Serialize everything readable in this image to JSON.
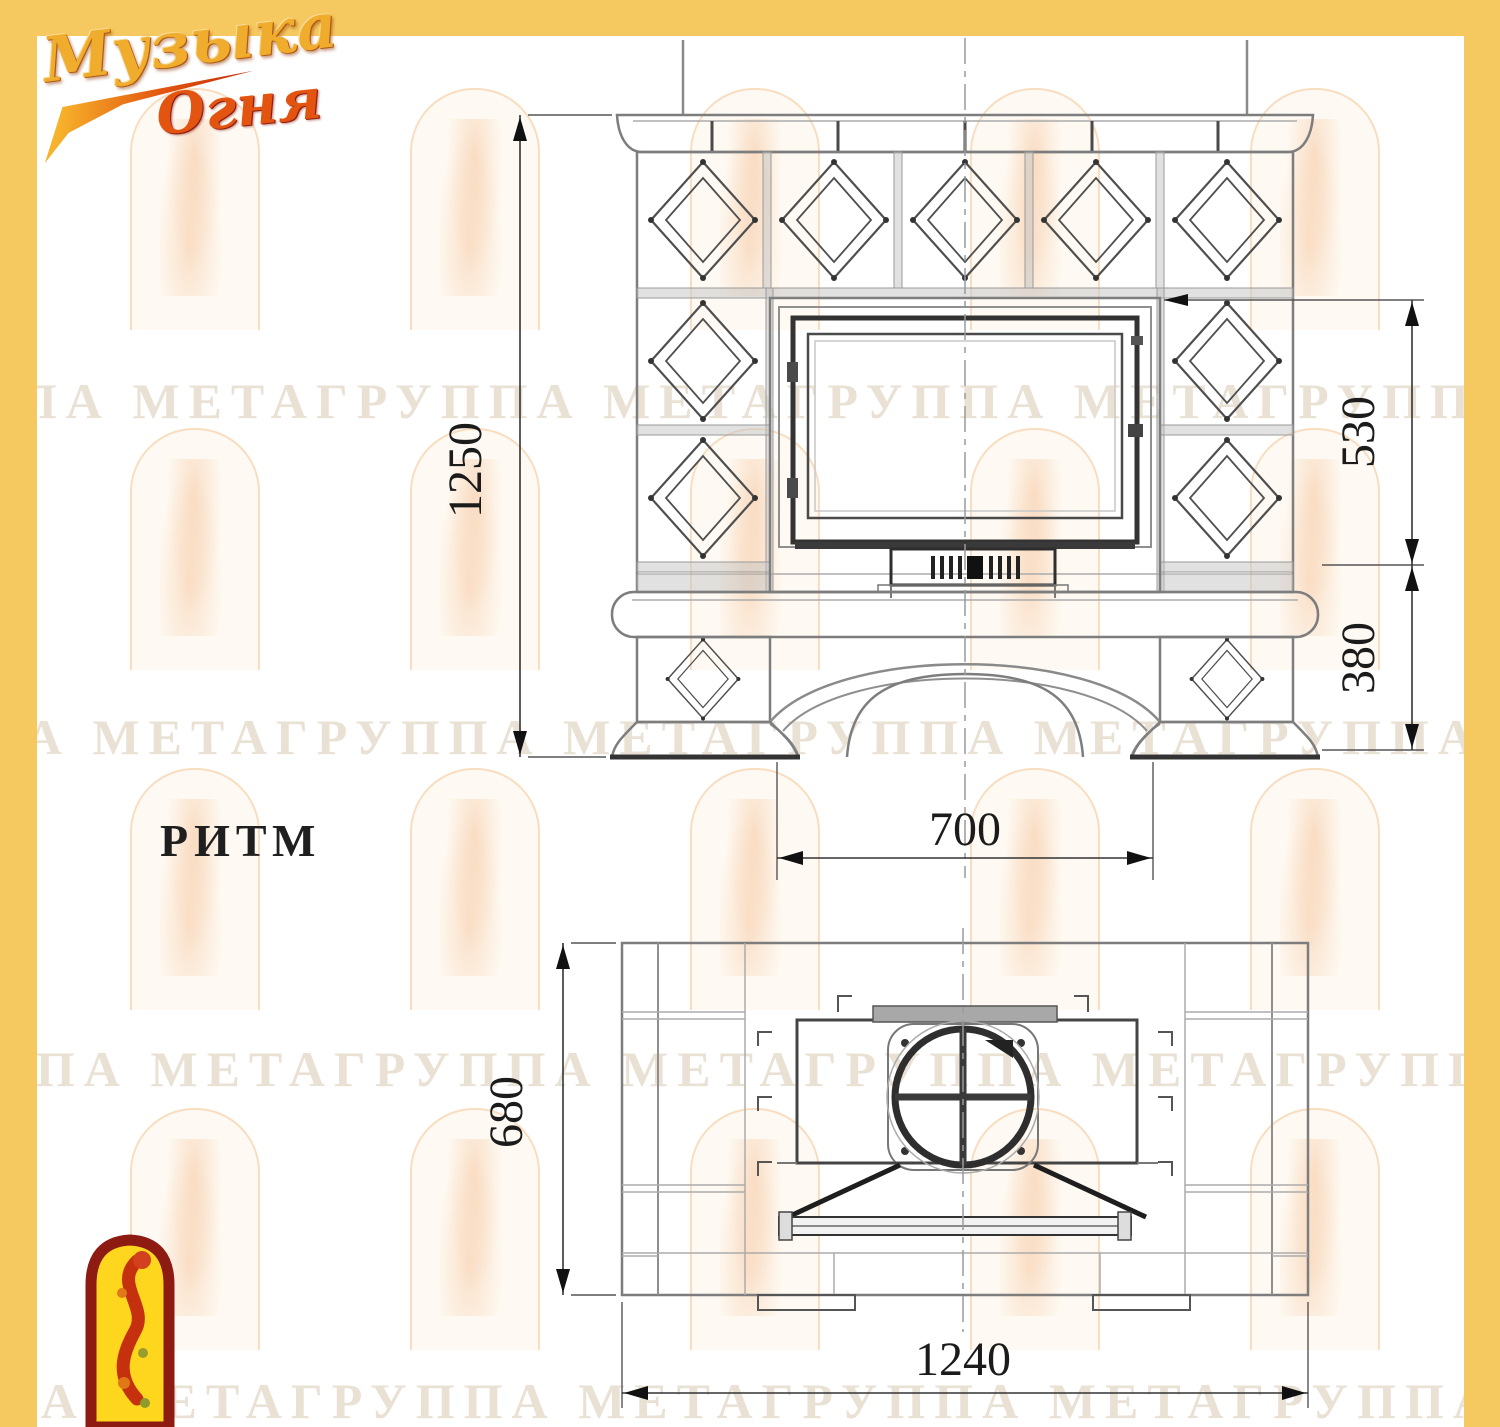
{
  "brand": {
    "word1": "Музыка",
    "word2": "Огня"
  },
  "model": {
    "name": "РИТМ"
  },
  "watermark": {
    "text": "ППА МЕТАГРУППА МЕТАГРУППА МЕТАГРУППА МЕТАГРУППА МЕТА"
  },
  "colors": {
    "frame_yellow": "#F5C95F",
    "logo_gold": "#F0AC2C",
    "logo_red": "#C5300F",
    "corner_logo_yellow": "#FFD61E",
    "drawing_line": "#7D7D7D",
    "dimension_text": "#1B1B1B"
  },
  "front_view": {
    "dims": {
      "total_height": "1250",
      "firebox_zone_height": "530",
      "base_zone_height": "380",
      "opening_width": "700"
    }
  },
  "plan_view": {
    "dims": {
      "depth": "680",
      "total_width": "1240"
    }
  }
}
